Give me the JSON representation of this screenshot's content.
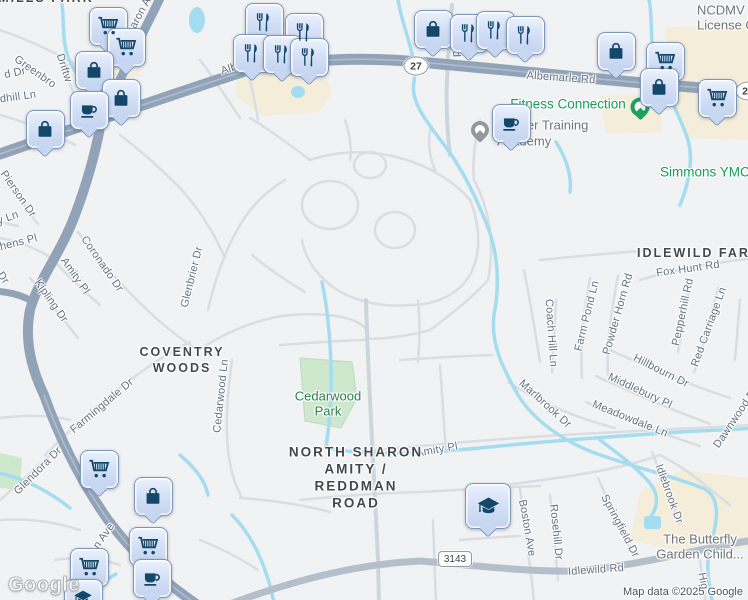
{
  "map": {
    "google_logo": "Google",
    "attribution": "Map data ©2025 Google"
  },
  "colors": {
    "land": "#f1f2f4",
    "road_major": "#92a3b8",
    "road_medium": "#b4bfcc",
    "road_minor": "#dadde1",
    "water": "#a5ddf0",
    "park": "#cde8cc",
    "commercial": "#f4edda",
    "pin_fill": "#d2def5",
    "pin_border": "#7d96b6",
    "pin_icon": "#14486a",
    "poi_green": "#169c57",
    "poi_gray": "#6e7378",
    "street_label": "#64717e",
    "neighborhood_label": "#44484c"
  },
  "route_shields": [
    {
      "label": "27",
      "shape": "oval",
      "x": 416,
      "y": 66
    },
    {
      "label": "27",
      "shape": "oval",
      "x": 748,
      "y": 91
    },
    {
      "label": "3143",
      "shape": "rect",
      "x": 455,
      "y": 559
    }
  ],
  "neighborhood_lines": [
    {
      "text": "MILLS PARK",
      "x": 46,
      "y": -2
    },
    {
      "text": "COVENTRY",
      "x": 182,
      "y": 352
    },
    {
      "text": "WOODS",
      "x": 182,
      "y": 368
    },
    {
      "text": "NORTH SHARON",
      "x": 356,
      "y": 452,
      "big": true
    },
    {
      "text": "AMITY /",
      "x": 356,
      "y": 469,
      "big": true
    },
    {
      "text": "REDDMAN",
      "x": 356,
      "y": 486,
      "big": true
    },
    {
      "text": "ROAD",
      "x": 356,
      "y": 503,
      "big": true
    },
    {
      "text": "IDLEWILD FARMS",
      "x": 637,
      "y": 253,
      "align": "left"
    }
  ],
  "poi_lines": [
    {
      "text": "Fitness Connection",
      "color": "green",
      "x": 568,
      "y": 104
    },
    {
      "text": "Simmons YMCA",
      "color": "green",
      "x": 660,
      "y": 172,
      "align": "left"
    },
    {
      "text": "NCDMV",
      "color": "gray",
      "x": 697,
      "y": 10,
      "align": "left"
    },
    {
      "text": "License O",
      "color": "gray",
      "x": 697,
      "y": 25,
      "align": "left"
    },
    {
      "text": "ier Training",
      "color": "gray",
      "x": 524,
      "y": 125,
      "align": "left"
    },
    {
      "text": "Academy",
      "color": "gray",
      "x": 497,
      "y": 141,
      "align": "left"
    },
    {
      "text": "The Butterfly",
      "color": "gray",
      "x": 700,
      "y": 539
    },
    {
      "text": "Garden Child...",
      "color": "gray",
      "x": 700,
      "y": 554
    },
    {
      "text": "Cedarwood",
      "color": "park",
      "x": 328,
      "y": 396
    },
    {
      "text": "Park",
      "color": "park",
      "x": 328,
      "y": 411
    }
  ],
  "street_labels": [
    {
      "text": "d Dr",
      "x": 15,
      "y": 73,
      "rot": -12
    },
    {
      "text": "Greenbro",
      "x": 35,
      "y": 72,
      "rot": 35
    },
    {
      "text": "Driftw",
      "x": 64,
      "y": 68,
      "rot": 72
    },
    {
      "text": "haron A",
      "x": 139,
      "y": 16,
      "rot": -62
    },
    {
      "text": "dhill Ln",
      "x": 18,
      "y": 97,
      "rot": -8
    },
    {
      "text": "Pierson Dr",
      "x": 18,
      "y": 194,
      "rot": 55
    },
    {
      "text": "y Ln",
      "x": 8,
      "y": 218,
      "rot": -20
    },
    {
      "text": "thens Pl",
      "x": 17,
      "y": 243,
      "rot": -14
    },
    {
      "text": "Dr",
      "x": 3,
      "y": 278,
      "rot": 55
    },
    {
      "text": "Coronado Dr",
      "x": 102,
      "y": 264,
      "rot": 55
    },
    {
      "text": "Amity Pl",
      "x": 75,
      "y": 276,
      "rot": 55
    },
    {
      "text": "Kipling Dr",
      "x": 51,
      "y": 301,
      "rot": 55
    },
    {
      "text": "Glenbrier Dr",
      "x": 192,
      "y": 277,
      "rot": -76
    },
    {
      "text": "Farmingdale Dr",
      "x": 102,
      "y": 406,
      "rot": -40
    },
    {
      "text": "Cedarwood Ln",
      "x": 221,
      "y": 396,
      "rot": -84
    },
    {
      "text": "Glendora Dr",
      "x": 38,
      "y": 471,
      "rot": -45
    },
    {
      "text": "n Ave",
      "x": 104,
      "y": 536,
      "rot": -55
    },
    {
      "text": "Alb",
      "x": 229,
      "y": 69,
      "rot": -18
    },
    {
      "text": "Albemarle Rd",
      "x": 561,
      "y": 78,
      "rot": 4
    },
    {
      "text": "Rd",
      "x": 456,
      "y": 50,
      "rot": 88
    },
    {
      "text": "Amity Pl",
      "x": 437,
      "y": 450,
      "rot": -10
    },
    {
      "text": "Idlewild Rd",
      "x": 596,
      "y": 570,
      "rot": -4
    },
    {
      "text": "Boston Ave",
      "x": 527,
      "y": 528,
      "rot": 80
    },
    {
      "text": "Rosehill Dr",
      "x": 556,
      "y": 532,
      "rot": 84
    },
    {
      "text": "Springfield Dr",
      "x": 620,
      "y": 526,
      "rot": 62
    },
    {
      "text": "Idlebrook Dr",
      "x": 669,
      "y": 494,
      "rot": 70
    },
    {
      "text": "Hig",
      "x": 703,
      "y": 581,
      "rot": 80
    },
    {
      "text": "Dawnwood D",
      "x": 735,
      "y": 419,
      "rot": -56
    },
    {
      "text": "Fox Hunt Rd",
      "x": 688,
      "y": 269,
      "rot": -8
    },
    {
      "text": "Farm Pond Ln",
      "x": 587,
      "y": 316,
      "rot": -76
    },
    {
      "text": "Powder Horn Rd",
      "x": 618,
      "y": 314,
      "rot": -74
    },
    {
      "text": "Pepperhill Rd",
      "x": 683,
      "y": 312,
      "rot": -78
    },
    {
      "text": "Red Carriage Ln",
      "x": 709,
      "y": 327,
      "rot": -70
    },
    {
      "text": "Coach Hill Ln",
      "x": 551,
      "y": 333,
      "rot": 86
    },
    {
      "text": "Marlbrook Dr",
      "x": 545,
      "y": 404,
      "rot": 42
    },
    {
      "text": "Hillbourn Dr",
      "x": 661,
      "y": 371,
      "rot": 27
    },
    {
      "text": "Middlebury Pl",
      "x": 640,
      "y": 391,
      "rot": 25
    },
    {
      "text": "Meadowdale Ln",
      "x": 630,
      "y": 419,
      "rot": 22
    }
  ],
  "poi_dots": [
    {
      "type": "gray",
      "x": 480,
      "y": 130
    },
    {
      "type": "green",
      "x": 640,
      "y": 107
    }
  ],
  "markers": [
    {
      "icon": "restaurant",
      "x": 263,
      "y": 21
    },
    {
      "icon": "restaurant",
      "x": 303,
      "y": 31
    },
    {
      "icon": "shopping-cart",
      "x": 107,
      "y": 25
    },
    {
      "icon": "shopping-cart",
      "x": 125,
      "y": 46
    },
    {
      "icon": "restaurant",
      "x": 251,
      "y": 52
    },
    {
      "icon": "restaurant",
      "x": 281,
      "y": 53
    },
    {
      "icon": "restaurant",
      "x": 308,
      "y": 56
    },
    {
      "icon": "shopping-bag",
      "x": 93,
      "y": 69
    },
    {
      "icon": "shopping-bag",
      "x": 120,
      "y": 97
    },
    {
      "icon": "coffee-cup",
      "x": 88,
      "y": 109
    },
    {
      "icon": "shopping-bag",
      "x": 44,
      "y": 128
    },
    {
      "icon": "shopping-bag",
      "x": 432,
      "y": 28
    },
    {
      "icon": "restaurant",
      "x": 468,
      "y": 32
    },
    {
      "icon": "restaurant",
      "x": 494,
      "y": 29
    },
    {
      "icon": "restaurant",
      "x": 524,
      "y": 34
    },
    {
      "icon": "shopping-bag",
      "x": 615,
      "y": 50
    },
    {
      "icon": "shopping-cart",
      "x": 664,
      "y": 60
    },
    {
      "icon": "shopping-bag",
      "x": 658,
      "y": 86
    },
    {
      "icon": "shopping-cart",
      "x": 716,
      "y": 97
    },
    {
      "icon": "coffee-cup",
      "x": 510,
      "y": 122
    },
    {
      "icon": "shopping-cart",
      "x": 98,
      "y": 468
    },
    {
      "icon": "shopping-bag",
      "x": 152,
      "y": 495
    },
    {
      "icon": "shopping-cart",
      "x": 147,
      "y": 545
    },
    {
      "icon": "shopping-cart",
      "x": 88,
      "y": 566
    },
    {
      "icon": "coffee-cup",
      "x": 151,
      "y": 577
    },
    {
      "icon": "graduation-cap",
      "x": 82,
      "y": 597
    },
    {
      "icon": "graduation-cap",
      "x": 487,
      "y": 505,
      "large": true
    }
  ]
}
